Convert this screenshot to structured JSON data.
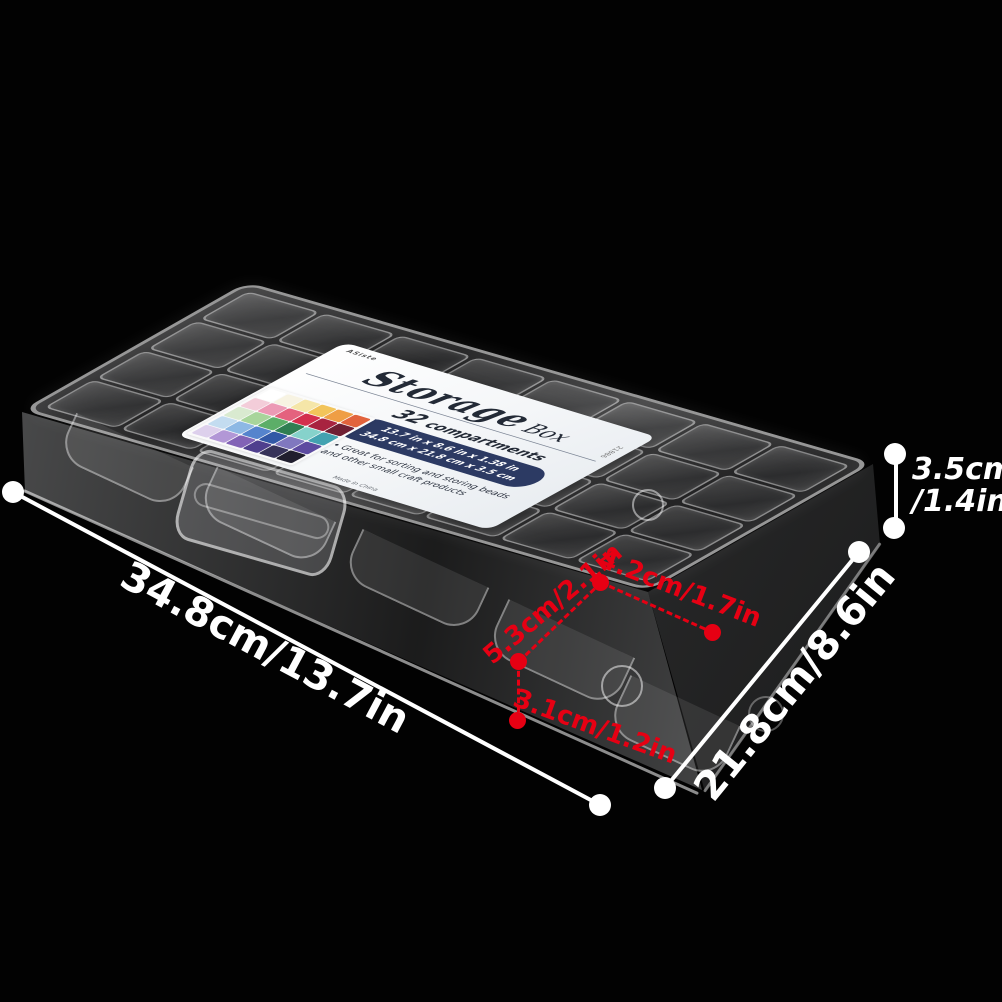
{
  "scene": {
    "background": "#020202"
  },
  "product": {
    "type": "plastic-storage-organizer-box",
    "grid": {
      "rows": 4,
      "cols": 8,
      "compartments": 32
    },
    "label": {
      "brand": "ASiste",
      "item_number": "21886",
      "title": "Storage",
      "title_suffix": "Box",
      "subtitle_count": "32",
      "subtitle_word": "compartments",
      "size_line_in": "13.7 in x 8.6 in x 1.38 in",
      "size_line_cm": "34.8 cm x 21.8 cm x 3.5 cm",
      "bullet_line1": "• Great for sorting and storing beads",
      "bullet_line2": "and other small craft products",
      "origin": "Made in China",
      "pill_color": "#2c3a63",
      "bead_photo_colors": [
        [
          "#ffffff",
          "#f7f3e2",
          "#f5e6a8",
          "#f2c45a",
          "#ef9e45",
          "#e2633c"
        ],
        [
          "#f3cdd9",
          "#ec9ab5",
          "#e4627e",
          "#d42f4d",
          "#a82340",
          "#6f1f33"
        ],
        [
          "#d9ead0",
          "#a8d59b",
          "#5cae68",
          "#2f7e52",
          "#86d2cb",
          "#43a2b0"
        ],
        [
          "#c3dcf0",
          "#8db8e4",
          "#5584cd",
          "#3258a6",
          "#8078bf",
          "#5d4ba0"
        ],
        [
          "#ddd0ec",
          "#b297d6",
          "#8263b6",
          "#4f3f8e",
          "#37335a",
          "#201e2e"
        ]
      ]
    }
  },
  "dimensions": {
    "accent_white": "#ffffff",
    "accent_red": "#e60013",
    "overall_length": "34.8cm/13.7in",
    "overall_depth": "21.8cm/8.6in",
    "overall_height_cm": "3.5cm",
    "overall_height_in": "/1.4in",
    "cell_long_side": "5.3cm/2.1in",
    "cell_short_side": "4.2cm/1.7in",
    "cell_depth": "3.1cm/1.2in"
  },
  "icons": {
    "white_dot": "measurement endpoint marker (filled circle)",
    "red_dot": "compartment measurement endpoint marker (filled circle)"
  }
}
